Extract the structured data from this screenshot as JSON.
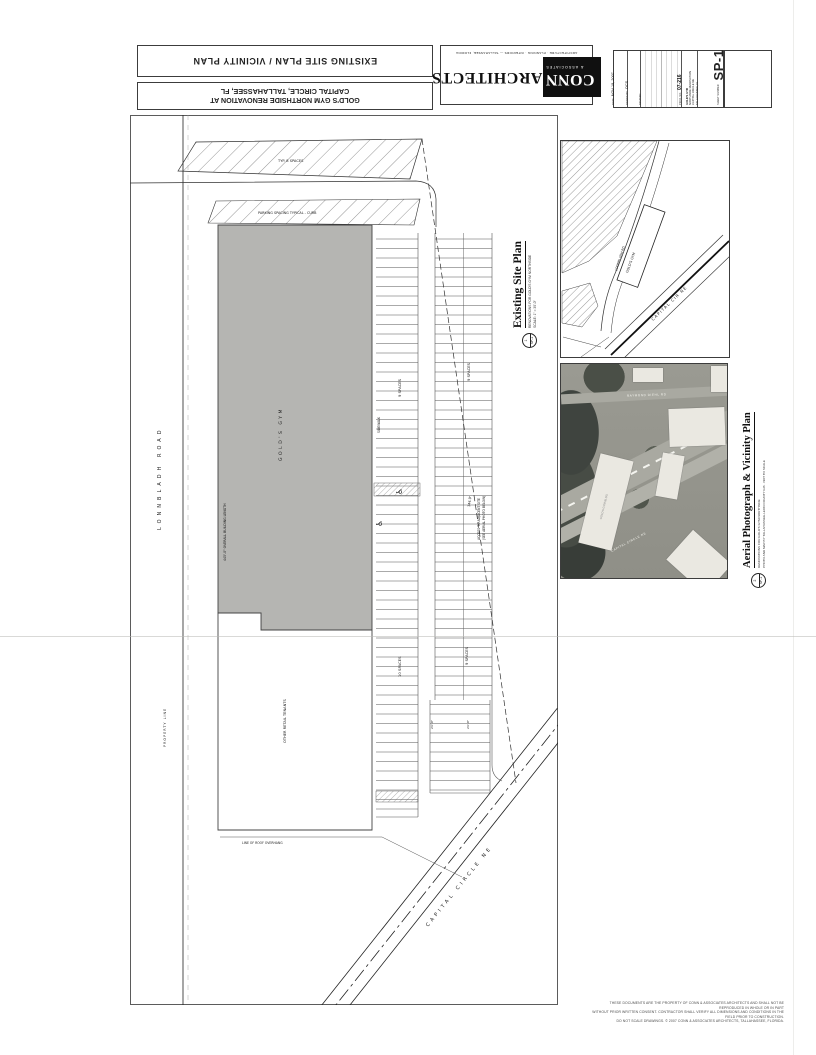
{
  "header": {
    "sheet_title": "EXISTING SITE PLAN / VICINITY PLAN",
    "project_line1": "GOLD'S GYM NORTHSIDE RENOVATION AT",
    "project_line2": "CAPITAL CIRCLE, TALLAHASSEE, FL",
    "logo": {
      "conn": "CONN",
      "architects": "ARCHITECTS",
      "associates": "& ASSOCIATES",
      "address": "ARCHITECTURE · PLANNING · INTERIORS — TALLAHASSEE, FLORIDA"
    },
    "titleblock": {
      "date_label": "DATE",
      "date_value": "NOV 19, 2007",
      "drawn_label": "DRAWN BY",
      "drawn_value": "OCS",
      "revised_label": "REVISED",
      "project_no_label": "PROJ. NO.",
      "project_no_value": "07-216",
      "project_name_lines": [
        "GOLD'S GYM",
        "NORTHSIDE RENOVATION",
        "CAPITAL CIRCLE NE",
        "TALLAHASSEE, FL"
      ],
      "sheet_label": "SHEET NUMBER",
      "sheet_value": "SP-1"
    }
  },
  "existing_plan_title": {
    "title": "Existing Site Plan",
    "sub1": "RENOVATIONS FOR GOLD'S GYM NORTHSIDE",
    "sub2": "SCALE: 1\" = 30'-0\"",
    "marker_number": "1",
    "marker_sheet": "SP-1"
  },
  "aerial_title": {
    "title": "Aerial Photograph & Vicinity Plan",
    "sub1": "RENOVATIONS FOR GOLD'S GYM NORTHSIDE",
    "sub2": "PHOTO AND MAP BY TALLAHASSEE-LEON COUNTY GIS · NOT TO SCALE",
    "marker_number": "2",
    "marker_sheet": "SP-1"
  },
  "site_plan": {
    "road_left": "LONNBLADH ROAD",
    "property_line": "PROPERTY LINE",
    "band1_label": "TYP. 8 SPACES",
    "band2_label": "PARKING SPACING TYPICAL - CURB",
    "building_label": "GOLD'S GYM",
    "building_length": "445'-0\" OVERALL BUILDING LENGTH",
    "other_tenants": "OTHER RETAIL TENANTS",
    "sidewalk": "SIDEWALK",
    "spaces_a1": "9 SPACES",
    "spaces_b1": "9 SPACES",
    "spaces_a2": "10 SPACES",
    "spaces_b2": "9 SPACES",
    "dim1": "24'-0\"",
    "dim2": "24'-0\"",
    "survey_dim": "344.9'",
    "access_note_line1": "ACCESS TO ADJACENT SITE",
    "access_note_line2": "(SEE AERIAL PHOTO BELOW)",
    "road_diagonal": "CAPITAL CIRCLE NE",
    "overhang_note": "LINE OF ROOF OVERHANG",
    "handicap_icon": "♿"
  },
  "vicinity_map": {
    "building_label": "GOLD'S GYM",
    "road_capital": "CAPITAL CIR NE",
    "road_lonnbladh": "LONNBLADH RD"
  },
  "aerial_photo": {
    "building_label": "GOLD'S GYM BLDG",
    "road_capital": "CAPITAL CIRCLE NE",
    "road_top": "RAYMOND DIEHL RD"
  },
  "fine_print": [
    "THESE DOCUMENTS ARE THE PROPERTY OF CONN & ASSOCIATES ARCHITECTS AND SHALL NOT BE REPRODUCED IN WHOLE OR IN PART",
    "WITHOUT PRIOR WRITTEN CONSENT. CONTRACTOR SHALL VERIFY ALL DIMENSIONS AND CONDITIONS IN THE FIELD PRIOR TO CONSTRUCTION.",
    "DO NOT SCALE DRAWINGS. © 2007 CONN & ASSOCIATES ARCHITECTS, TALLAHASSEE, FLORIDA."
  ],
  "colors": {
    "ink": "#222222",
    "building_fill": "#b5b5b2",
    "photo_base": "#97978f"
  }
}
